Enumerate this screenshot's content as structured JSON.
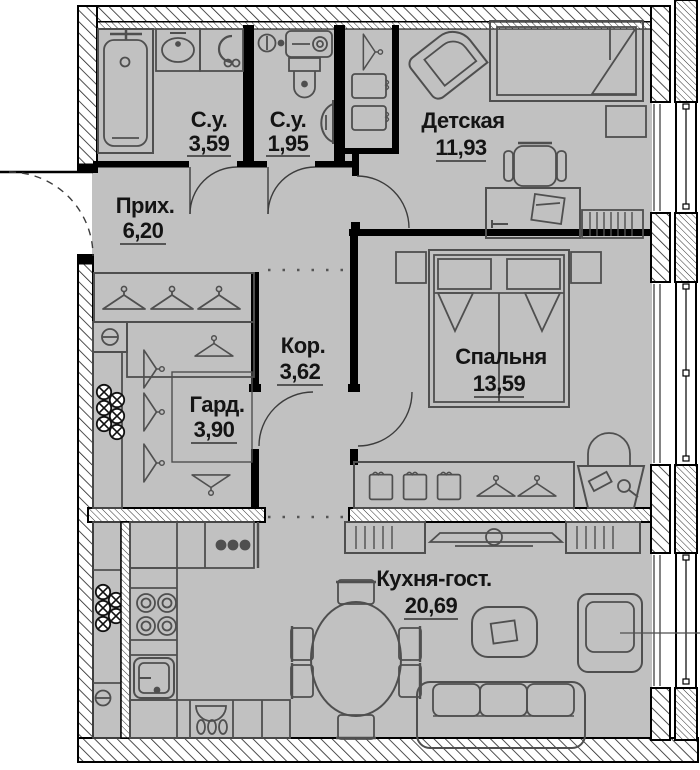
{
  "plan": {
    "type": "apartment-floor-plan",
    "rooms": [
      {
        "id": "su1",
        "name": "С.у.",
        "area": "3,59"
      },
      {
        "id": "su2",
        "name": "С.у.",
        "area": "1,95"
      },
      {
        "id": "detskaya",
        "name": "Детская",
        "area": "11,93"
      },
      {
        "id": "prihozhaya",
        "name": "Прих.",
        "area": "6,20"
      },
      {
        "id": "koridor",
        "name": "Кор.",
        "area": "3,62"
      },
      {
        "id": "garderob",
        "name": "Гард.",
        "area": "3,90"
      },
      {
        "id": "spalnya",
        "name": "Спальня",
        "area": "13,59"
      },
      {
        "id": "kuhnya",
        "name": "Кухня-гост.",
        "area": "20,69"
      }
    ],
    "colors": {
      "floor": "#c1c1c1",
      "wall": "#000000",
      "furniture": "#4f4f4f",
      "text": "#141414"
    }
  }
}
